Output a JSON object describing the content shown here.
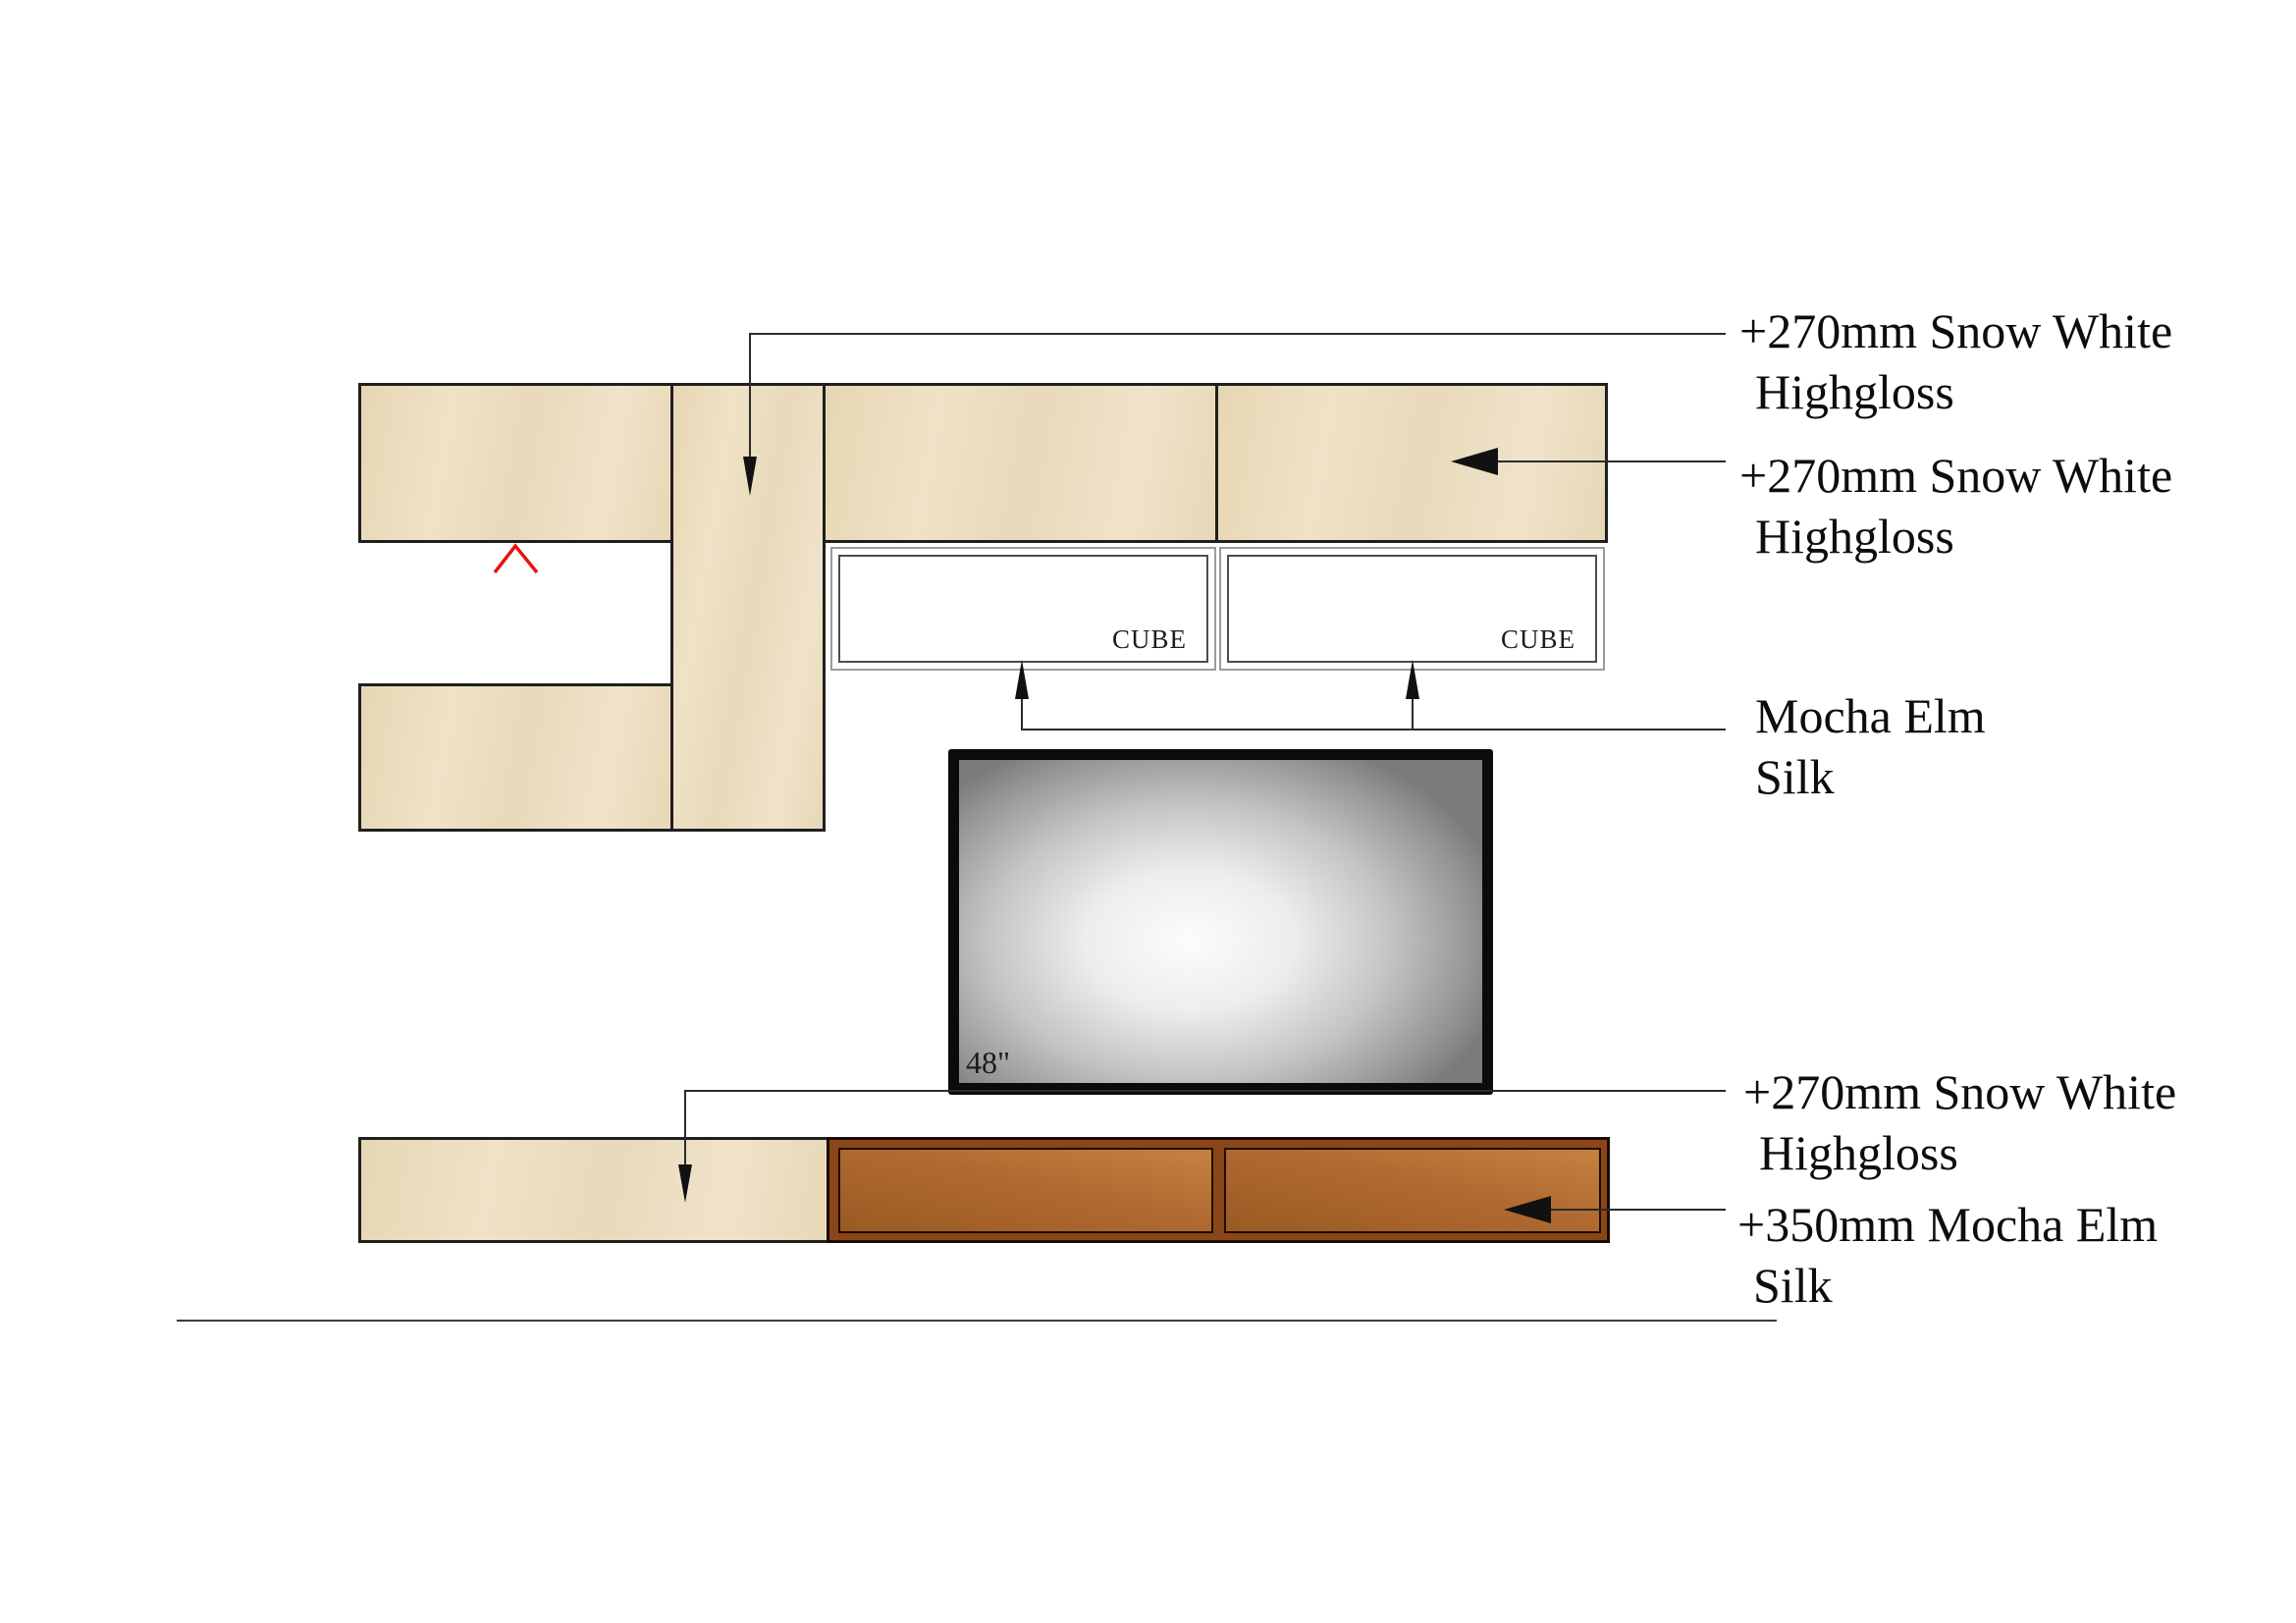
{
  "drawing": {
    "annotations": {
      "top_panel": {
        "line1": "+270mm Snow White",
        "line2": "Highgloss"
      },
      "top_right_cabinet": {
        "line1": "+270mm Snow White",
        "line2": "Highgloss"
      },
      "cube_shelves": {
        "line1": "Mocha Elm",
        "line2": "Silk"
      },
      "bottom_left_cabinet": {
        "line1": "+270mm Snow White",
        "line2": "Highgloss"
      },
      "bottom_right_unit": {
        "line1": "+350mm Mocha Elm",
        "line2": "Silk"
      }
    },
    "cubes": {
      "left": {
        "label": "CUBE"
      },
      "right": {
        "label": "CUBE"
      }
    },
    "tv": {
      "size_label": "48\""
    },
    "colors": {
      "cabinet_cream": "#ecdfc3",
      "cabinet_outline": "#1f1f1f",
      "cube_border_outer": "#9b9b9b",
      "cube_border_inner": "#4d4d4d",
      "tv_frame": "#0b0b0b",
      "brown_frame": "#8a4617",
      "door_copper_light": "#c58240",
      "door_copper_dark": "#9a5a24",
      "marker_red": "#e81313",
      "leader_line": "#2b2b2b"
    }
  }
}
